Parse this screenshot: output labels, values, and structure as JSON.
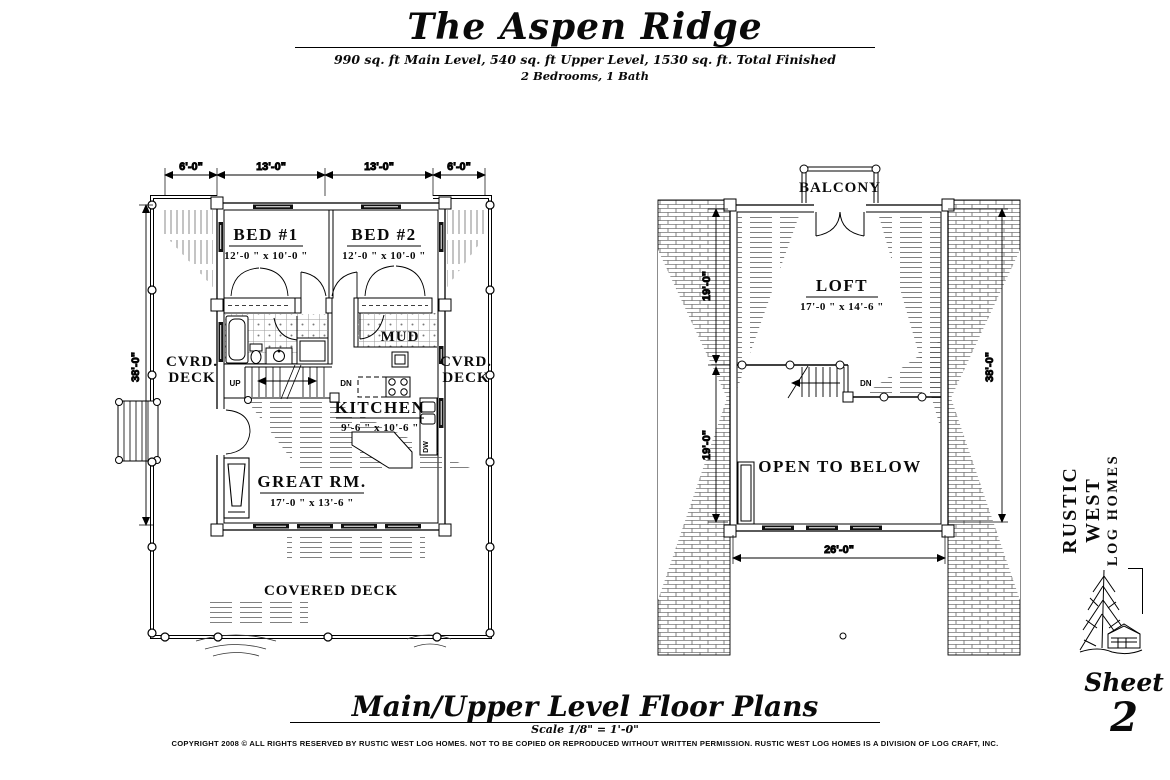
{
  "header": {
    "title": "The Aspen Ridge",
    "subtitle1": "990 sq. ft Main Level, 540 sq. ft Upper Level, 1530 sq. ft. Total Finished",
    "subtitle2": "2 Bedrooms, 1 Bath"
  },
  "main_plan": {
    "dims": {
      "top": [
        "6'-0\"",
        "13'-0\"",
        "13'-0\"",
        "6'-0\""
      ],
      "left": "38'-0\""
    },
    "rooms": {
      "bed1": {
        "name": "BED #1",
        "size": "12'-0 \" x 10'-0 \""
      },
      "bed2": {
        "name": "BED #2",
        "size": "12'-0 \" x 10'-0 \""
      },
      "kitchen": {
        "name": "KITCHEN",
        "size": "9'-6 \" x 10'-6 \""
      },
      "great_room": {
        "name": "GREAT RM.",
        "size": "17'-0 \" x 13'-6 \""
      },
      "mud": "MUD"
    },
    "labels": {
      "up": "UP",
      "dn": "DN",
      "dw": "DW",
      "cvrd_line1": "CVRD.",
      "cvrd_line2": "DECK",
      "covered_deck": "COVERED DECK"
    }
  },
  "upper_plan": {
    "balcony": "BALCONY",
    "loft": {
      "name": "LOFT",
      "size": "17'-0 \" x 14'-6 \""
    },
    "open_to_below": "OPEN TO BELOW",
    "dn": "DN",
    "dims": {
      "left_upper": "19'-0\"",
      "left_lower": "19'-0\"",
      "right": "38'-0\"",
      "bottom": "26'-0\""
    }
  },
  "sidebar": {
    "brand_line1": "RUSTIC WEST",
    "brand_line2": "LOG HOMES",
    "sheet_label": "Sheet",
    "sheet_number": "2"
  },
  "footer": {
    "title": "Main/Upper Level Floor Plans",
    "scale": "Scale 1/8\" = 1'-0\"",
    "copyright": "COPYRIGHT 2008 © ALL RIGHTS RESERVED BY RUSTIC WEST LOG HOMES. NOT TO BE COPIED OR REPRODUCED WITHOUT WRITTEN PERMISSION. RUSTIC WEST LOG HOMES IS A DIVISION OF LOG CRAFT, INC."
  }
}
